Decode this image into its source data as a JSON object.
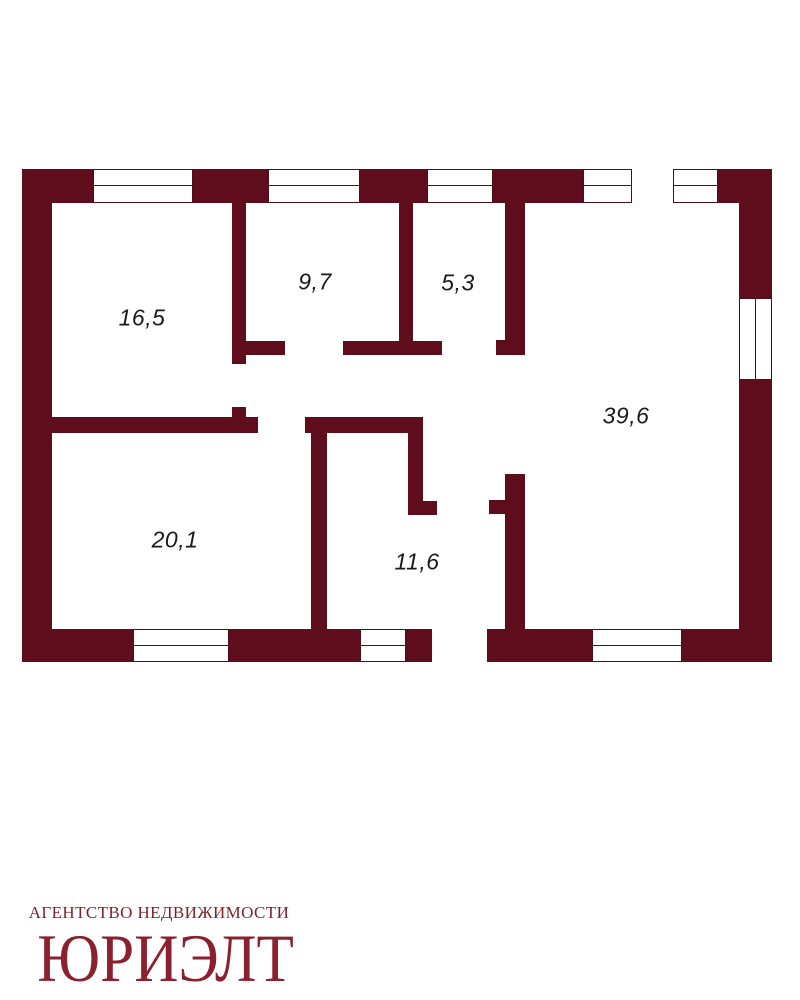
{
  "floor_plan": {
    "rooms": [
      {
        "name": "room-16-5",
        "area": "16,5"
      },
      {
        "name": "room-9-7",
        "area": "9,7"
      },
      {
        "name": "room-5-3",
        "area": "5,3"
      },
      {
        "name": "room-39-6",
        "area": "39,6"
      },
      {
        "name": "room-20-1",
        "area": "20,1"
      },
      {
        "name": "room-11-6",
        "area": "11,6"
      }
    ]
  },
  "logo": {
    "agency_line": "АГЕНТСТВО НЕДВИЖИМОСТИ",
    "brand": "ЮРИЭЛТ"
  },
  "colors": {
    "wall": "#5F0C1D",
    "window_line": "#4E0C18",
    "label": "#1A1A1A",
    "logo_brand": "#8B2130",
    "logo_agency": "#7E1F2C"
  }
}
